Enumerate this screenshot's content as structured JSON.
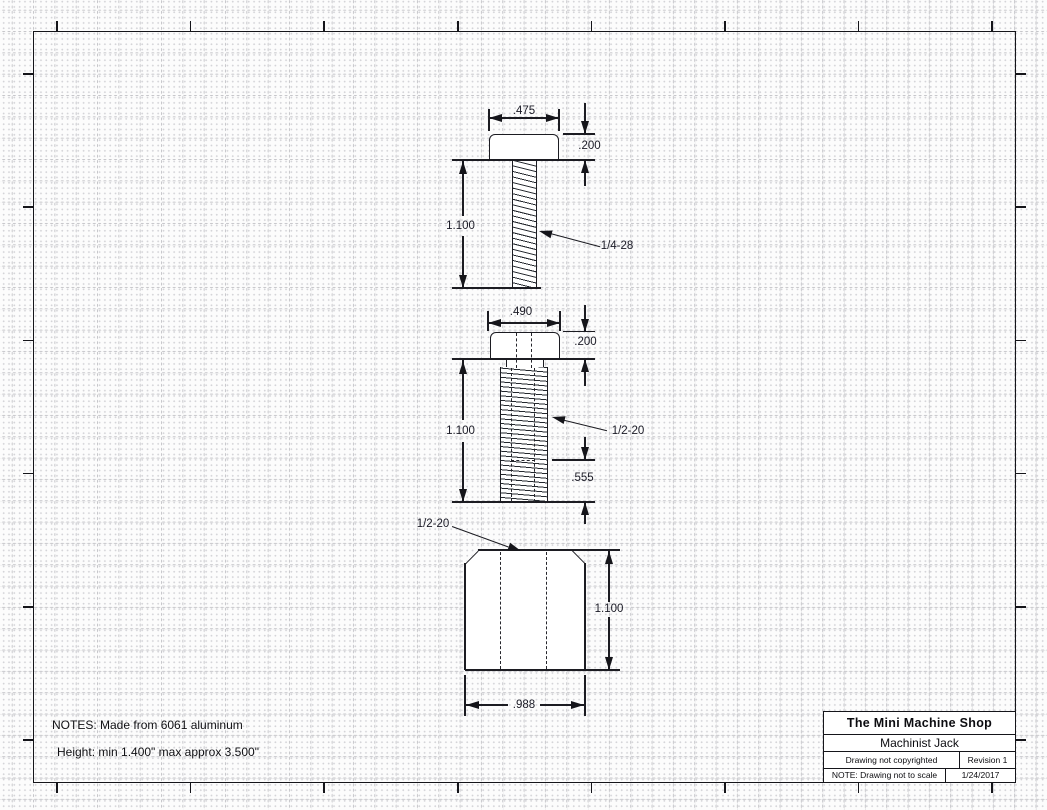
{
  "views": {
    "top_screw": {
      "width_dim": ".475",
      "head_height_dim": ".200",
      "length_dim": "1.100",
      "thread_label": "1/4-28"
    },
    "middle_screw": {
      "width_dim": ".490",
      "head_height_dim": ".200",
      "length_dim": "1.100",
      "thread_label": "1/2-20",
      "hole_depth_dim": ".555"
    },
    "base_body": {
      "thread_label": "1/2-20",
      "height_dim": "1.100",
      "width_dim": ".988"
    }
  },
  "notes": {
    "line1": "NOTES: Made from 6061 aluminum",
    "line2": "Height: min 1.400\" max approx 3.500\""
  },
  "title_block": {
    "company": "The Mini Machine Shop",
    "part_name": "Machinist Jack",
    "copyright": "Drawing not copyrighted",
    "revision": "Revision  1",
    "scale_note": "NOTE: Drawing not to scale",
    "date": "1/24/2017"
  },
  "colors": {
    "line": "#1c1c22",
    "background": "#fcfcfc"
  }
}
